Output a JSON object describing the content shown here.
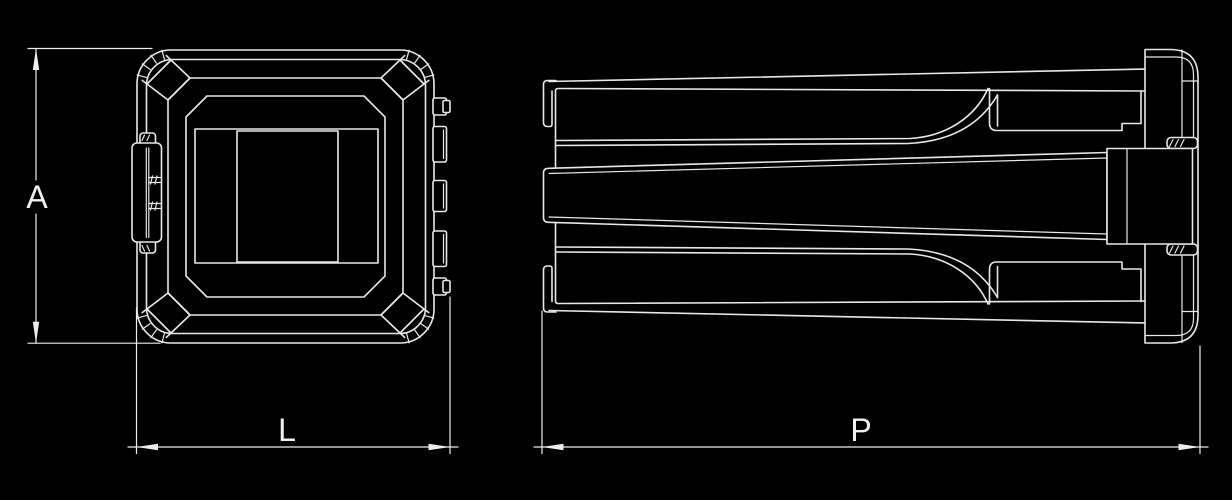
{
  "drawing": {
    "description": "technical drawing, two views of square tube insert",
    "colors": {
      "background": "#000000",
      "line": "#e8e8e8",
      "text": "#f0f0f0"
    },
    "dimensions": {
      "a": {
        "label": "A"
      },
      "l": {
        "label": "L"
      },
      "p": {
        "label": "P"
      }
    }
  }
}
